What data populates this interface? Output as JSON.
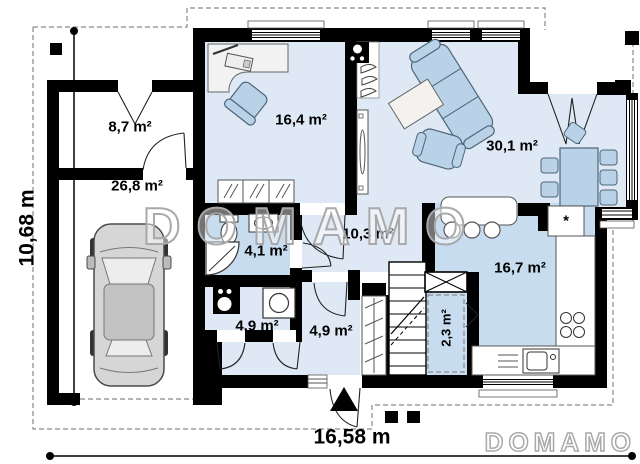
{
  "plan": {
    "rooms": [
      {
        "id": "storage",
        "label": "8,7 m²"
      },
      {
        "id": "garage",
        "label": "26,8 m²"
      },
      {
        "id": "office",
        "label": "16,4 m²"
      },
      {
        "id": "living",
        "label": "30,1 m²"
      },
      {
        "id": "bathroom",
        "label": "4,1 m²"
      },
      {
        "id": "hall",
        "label": "10,3 m²"
      },
      {
        "id": "kitchen",
        "label": "16,7 m²"
      },
      {
        "id": "utility",
        "label": "4,9 m²"
      },
      {
        "id": "entry",
        "label": "4,9 m²"
      },
      {
        "id": "pantry",
        "label": "2,3 m²"
      }
    ],
    "dimensions": {
      "width_label": "16,58 m",
      "height_label": "10,68 m"
    },
    "watermark": {
      "text": "DOMAMO"
    },
    "symbols": {
      "fridge": "*"
    },
    "colors": {
      "wall": "#000000",
      "floor_light": "#dfe9f5",
      "floor_medium": "#c8dcef",
      "furniture_blue": "#b9d2e8",
      "watermark_gray": "#a9a9a9"
    }
  }
}
